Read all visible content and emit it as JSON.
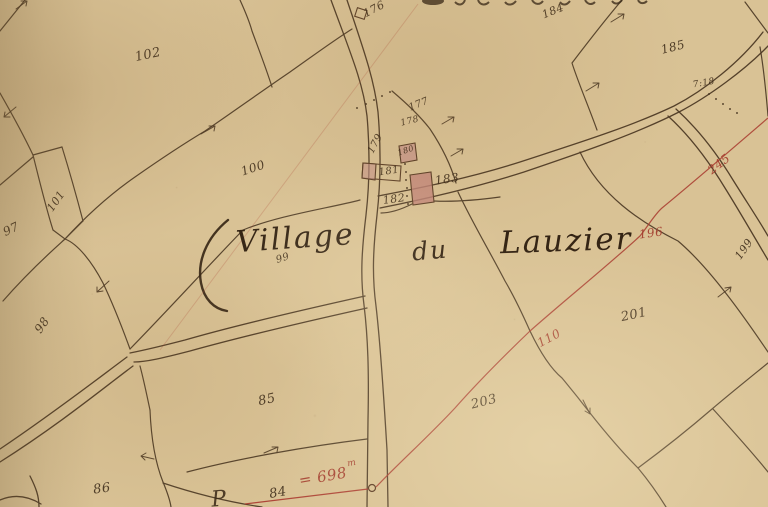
{
  "map": {
    "title": {
      "word1": "Village",
      "word2": "du",
      "word3": "Lauzier",
      "full": "Village du Lauzier"
    },
    "colors": {
      "paper": "#d9c295",
      "ink": "#42301e",
      "red_ink": "#a8392e",
      "building_fill": "#c6938a"
    },
    "benchmark": {
      "value": "= 698",
      "unit": "m"
    },
    "labels": [
      {
        "name": "parcel-102",
        "text": "102",
        "x": 148,
        "y": 55,
        "rot": -12,
        "size": 13
      },
      {
        "name": "parcel-176",
        "text": "176",
        "x": 374,
        "y": 9,
        "rot": -28,
        "size": 11
      },
      {
        "name": "parcel-184",
        "text": "184",
        "x": 553,
        "y": 11,
        "rot": -22,
        "size": 11
      },
      {
        "name": "parcel-185",
        "text": "185",
        "x": 673,
        "y": 47,
        "rot": -14,
        "size": 12
      },
      {
        "name": "survey-note-718",
        "text": "7:18",
        "x": 704,
        "y": 84,
        "rot": -10,
        "size": 9
      },
      {
        "name": "parcel-100",
        "text": "100",
        "x": 253,
        "y": 168,
        "rot": -18,
        "size": 12
      },
      {
        "name": "parcel-177",
        "text": "177",
        "x": 419,
        "y": 105,
        "rot": -22,
        "size": 10
      },
      {
        "name": "parcel-178",
        "text": "178",
        "x": 410,
        "y": 122,
        "rot": -14,
        "size": 9
      },
      {
        "name": "parcel-179",
        "text": "179",
        "x": 376,
        "y": 144,
        "rot": -62,
        "size": 10
      },
      {
        "name": "parcel-180",
        "text": "180",
        "x": 406,
        "y": 151,
        "rot": -18,
        "size": 8
      },
      {
        "name": "parcel-181",
        "text": "181",
        "x": 389,
        "y": 172,
        "rot": -8,
        "size": 10
      },
      {
        "name": "parcel-182",
        "text": "182",
        "x": 394,
        "y": 199,
        "rot": -8,
        "size": 11
      },
      {
        "name": "parcel-183",
        "text": "183",
        "x": 447,
        "y": 179,
        "rot": -8,
        "size": 12
      },
      {
        "name": "parcel-101",
        "text": "101",
        "x": 56,
        "y": 201,
        "rot": -55,
        "size": 11
      },
      {
        "name": "parcel-97",
        "text": "97",
        "x": 11,
        "y": 229,
        "rot": -25,
        "size": 12
      },
      {
        "name": "parcel-98",
        "text": "98",
        "x": 42,
        "y": 325,
        "rot": -55,
        "size": 12
      },
      {
        "name": "parcel-99",
        "text": "99",
        "x": 283,
        "y": 259,
        "rot": -18,
        "size": 10
      },
      {
        "name": "parcel-201",
        "text": "201",
        "x": 634,
        "y": 315,
        "rot": -12,
        "size": 13
      },
      {
        "name": "parcel-199",
        "text": "199",
        "x": 744,
        "y": 249,
        "rot": -55,
        "size": 11
      },
      {
        "name": "parcel-203",
        "text": "203",
        "x": 484,
        "y": 402,
        "rot": -14,
        "size": 13
      },
      {
        "name": "parcel-85",
        "text": "85",
        "x": 267,
        "y": 400,
        "rot": -12,
        "size": 13
      },
      {
        "name": "parcel-86",
        "text": "86",
        "x": 102,
        "y": 489,
        "rot": -8,
        "size": 13
      },
      {
        "name": "parcel-84",
        "text": "84",
        "x": 278,
        "y": 493,
        "rot": -10,
        "size": 13
      },
      {
        "name": "letter-p",
        "text": "P",
        "x": 219,
        "y": 500,
        "rot": -5,
        "size": 22
      },
      {
        "name": "red-survey-245",
        "text": "245",
        "x": 719,
        "y": 164,
        "rot": -38,
        "size": 12,
        "red": true
      },
      {
        "name": "red-survey-196",
        "text": "196",
        "x": 651,
        "y": 233,
        "rot": -8,
        "size": 12,
        "red": true
      },
      {
        "name": "red-survey-110",
        "text": "110",
        "x": 549,
        "y": 338,
        "rot": -28,
        "size": 12,
        "red": true
      },
      {
        "name": "red-measure-698",
        "text": "= 698",
        "x": 323,
        "y": 477,
        "rot": -10,
        "size": 15,
        "red": true
      },
      {
        "name": "red-measure-unit-m",
        "text": "m",
        "x": 352,
        "y": 464,
        "rot": -10,
        "size": 9,
        "red": true
      }
    ]
  }
}
